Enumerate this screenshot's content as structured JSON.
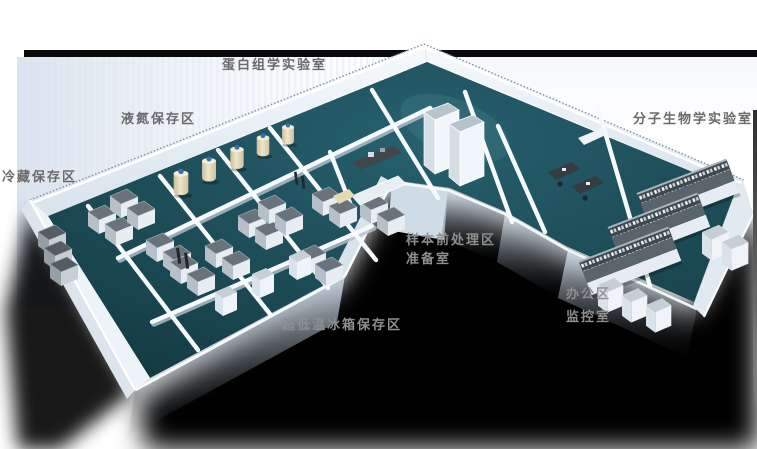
{
  "scene": {
    "description": "3D perspective rendering of a biobank laboratory floor plan",
    "background_color": "#ffffff",
    "backdrop_tint": "#dce6f0",
    "top_rule_color": "#0a0a0c",
    "floor_color": "#1c4b55",
    "wall_color": "#eef3f8",
    "shadow_color": "#000000",
    "freezer_color": "#6a737b",
    "nitrogen_tank_color": "#e2d5b4",
    "tank_cap_color": "#3a6fae",
    "bench_color": "#59646c"
  },
  "labels": [
    {
      "id": "proteomics-lab",
      "text": "蛋白组学实验室",
      "tone": "dark"
    },
    {
      "id": "liquid-nitrogen-storage",
      "text": "液氮保存区",
      "tone": "dark"
    },
    {
      "id": "cold-storage",
      "text": "冷藏保存区",
      "tone": "dark"
    },
    {
      "id": "molecular-biology-lab",
      "text": "分子生物学实验室",
      "tone": "dark"
    },
    {
      "id": "sample-pretreatment-area",
      "text": "样本前处理区",
      "tone": "light"
    },
    {
      "id": "prep-room",
      "text": "准备室",
      "tone": "light"
    },
    {
      "id": "office-area",
      "text": "办公区",
      "tone": "light"
    },
    {
      "id": "monitoring-room",
      "text": "监控室",
      "tone": "light"
    },
    {
      "id": "ult-freezer-storage",
      "text": "超低温冰箱保存区",
      "tone": "light"
    }
  ]
}
